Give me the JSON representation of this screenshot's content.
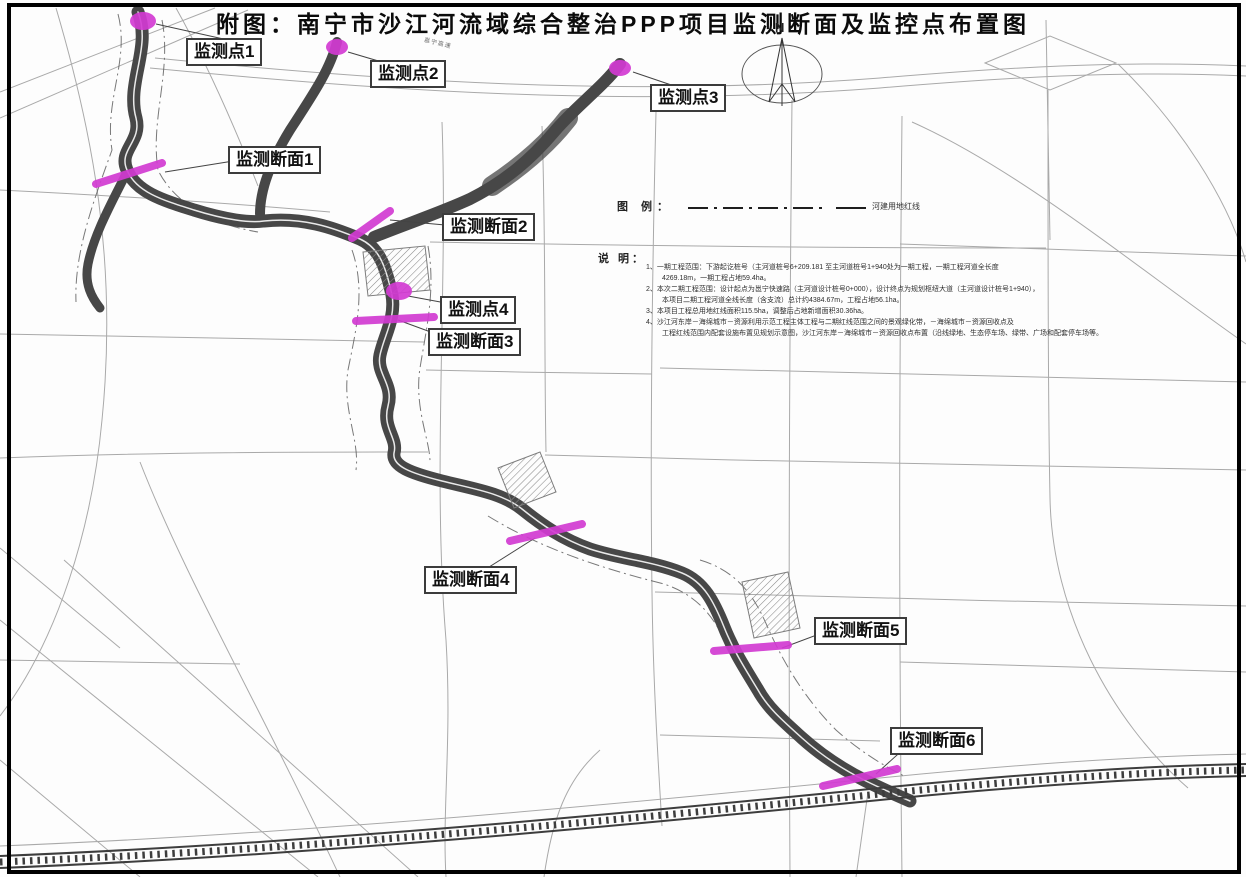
{
  "title": "附图：南宁市沙江河流域综合整治PPP项目监测断面及监控点布置图",
  "compass": {
    "label": "N"
  },
  "legend": {
    "heading": "图 例：",
    "items": [
      {
        "symbol": "dash-dot-line",
        "label": "河建用地红线"
      }
    ]
  },
  "notes": {
    "heading": "说 明：",
    "lines": [
      "1、一期工程范围：下游起讫桩号（主河道桩号6+209.181 至主河道桩号1+940处为一期工程，一期工程河道全长度",
      "4269.18m，一期工程占地59.4ha。",
      "2、本次二期工程范围：设计起点为邕宁快速路（主河道设计桩号0+000），设计终点为规划枢纽大道（主河道设计桩号1+940），",
      "本项目二期工程河道全线长度（含支流）总计约4384.67m，工程占地56.1ha。",
      "3、本项目工程总用地红线面积115.5ha，调整后占地新增面积30.36ha。",
      "4、沙江河东岸－海绵城市－资源利用示范工程主体工程与二期红线范围之间的景观绿化带，－海绵城市－资源回收点及",
      "工程红线范围内配套设施布置见规划示意图，沙江河东岸－海绵城市－资源回收点布置（沿线绿地、生态停车场、绿带、广场和配套停车场等。"
    ]
  },
  "markers": {
    "points": [
      {
        "label": "监测点1"
      },
      {
        "label": "监测点2"
      },
      {
        "label": "监测点3"
      },
      {
        "label": "监测点4"
      }
    ],
    "sections": [
      {
        "label": "监测断面1"
      },
      {
        "label": "监测断面2"
      },
      {
        "label": "监测断面3"
      },
      {
        "label": "监测断面4"
      },
      {
        "label": "监测断面5"
      },
      {
        "label": "监测断面6"
      }
    ]
  },
  "road_labels": [
    {
      "label": "邕宁高速"
    }
  ],
  "colors": {
    "marker": "#d23bd2",
    "river": "#474747",
    "street": "#9b9b9b",
    "frame": "#000000"
  }
}
